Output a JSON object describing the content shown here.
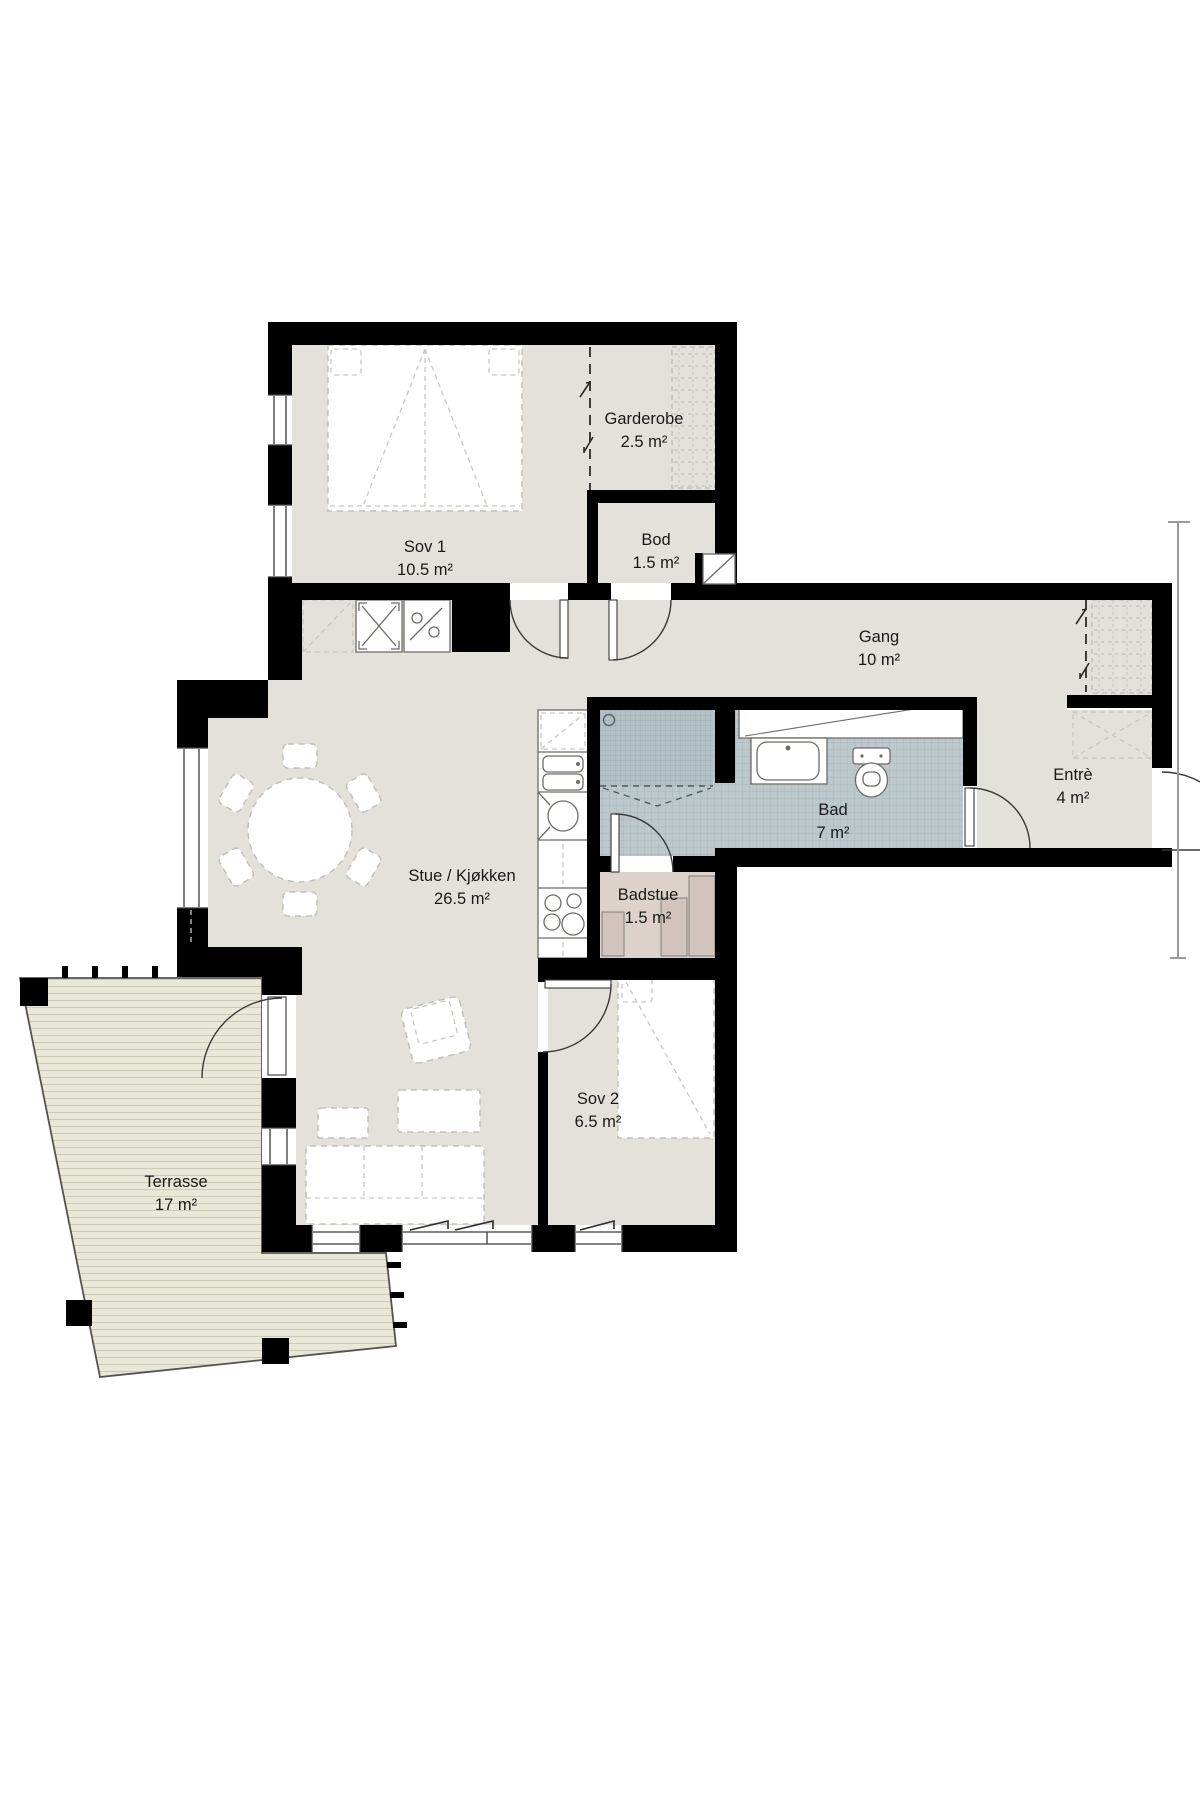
{
  "floorplan": {
    "rooms": [
      {
        "name": "Sov 1",
        "area": "10.5 m²"
      },
      {
        "name": "Garderobe",
        "area": "2.5 m²"
      },
      {
        "name": "Bod",
        "area": "1.5 m²"
      },
      {
        "name": "Gang",
        "area": "10 m²"
      },
      {
        "name": "Entrè",
        "area": "4 m²"
      },
      {
        "name": "Bad",
        "area": "7 m²"
      },
      {
        "name": "Badstue",
        "area": "1.5 m²"
      },
      {
        "name": "Stue / Kjøkken",
        "area": "26.5 m²"
      },
      {
        "name": "Sov 2",
        "area": "6.5 m²"
      },
      {
        "name": "Terrasse",
        "area": "17 m²"
      }
    ],
    "colors": {
      "walls": "#000000",
      "floor": "#e4e1da",
      "bath_tile": "#bcc8cc",
      "shower_tile": "#b3c1c6",
      "sauna_floor": "#ddd2cb",
      "deck": "#e9e7d8",
      "background": "#ffffff"
    }
  }
}
